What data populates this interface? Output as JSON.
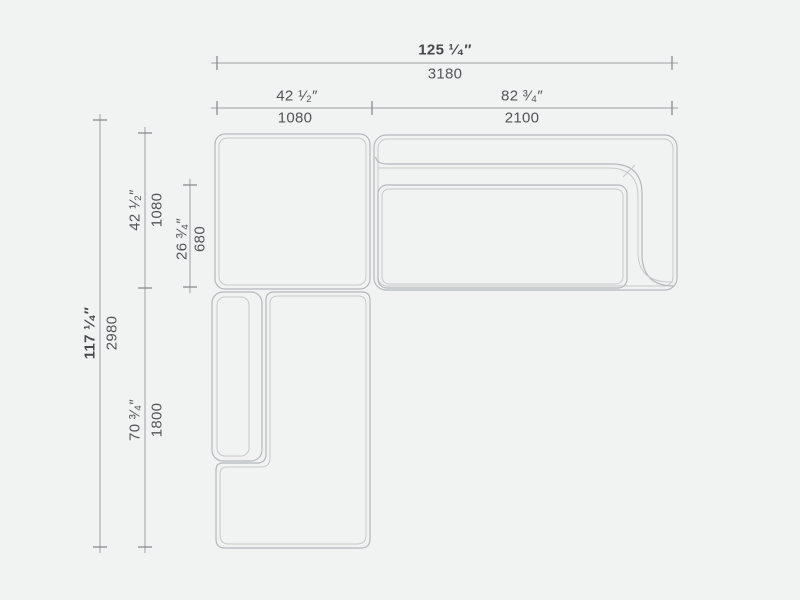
{
  "drawing": {
    "kind": "sectional-sofa-plan-dimension-drawing",
    "units": [
      "inches",
      "millimeters"
    ]
  },
  "dimensions": {
    "horizontal": [
      {
        "name": "overall-width",
        "inches": "125 ¹⁄₄″",
        "mm": "3180"
      },
      {
        "name": "left-section-width",
        "inches": "42 ¹⁄₂″",
        "mm": "1080"
      },
      {
        "name": "right-section-width",
        "inches": "82 ³⁄₄″",
        "mm": "2100"
      }
    ],
    "vertical": [
      {
        "name": "overall-depth",
        "inches": "117 ¹⁄₄″",
        "mm": "2980"
      },
      {
        "name": "upper-section-depth",
        "inches": "42 ¹⁄₂″",
        "mm": "1080"
      },
      {
        "name": "seat-depth",
        "inches": "26 ³⁄₄″",
        "mm": "680"
      },
      {
        "name": "chaise-section-length",
        "inches": "70 ³⁄₄″",
        "mm": "1800"
      }
    ]
  },
  "colors": {
    "background": "#f1f2f2",
    "furniture_outline": "#b5b9bb",
    "furniture_inner_line": "#c6c9cb",
    "dimension_line": "#9ba1a4",
    "tick_mark": "#878d90",
    "label_text": "#515557",
    "label_text_bold": "#45494b"
  }
}
